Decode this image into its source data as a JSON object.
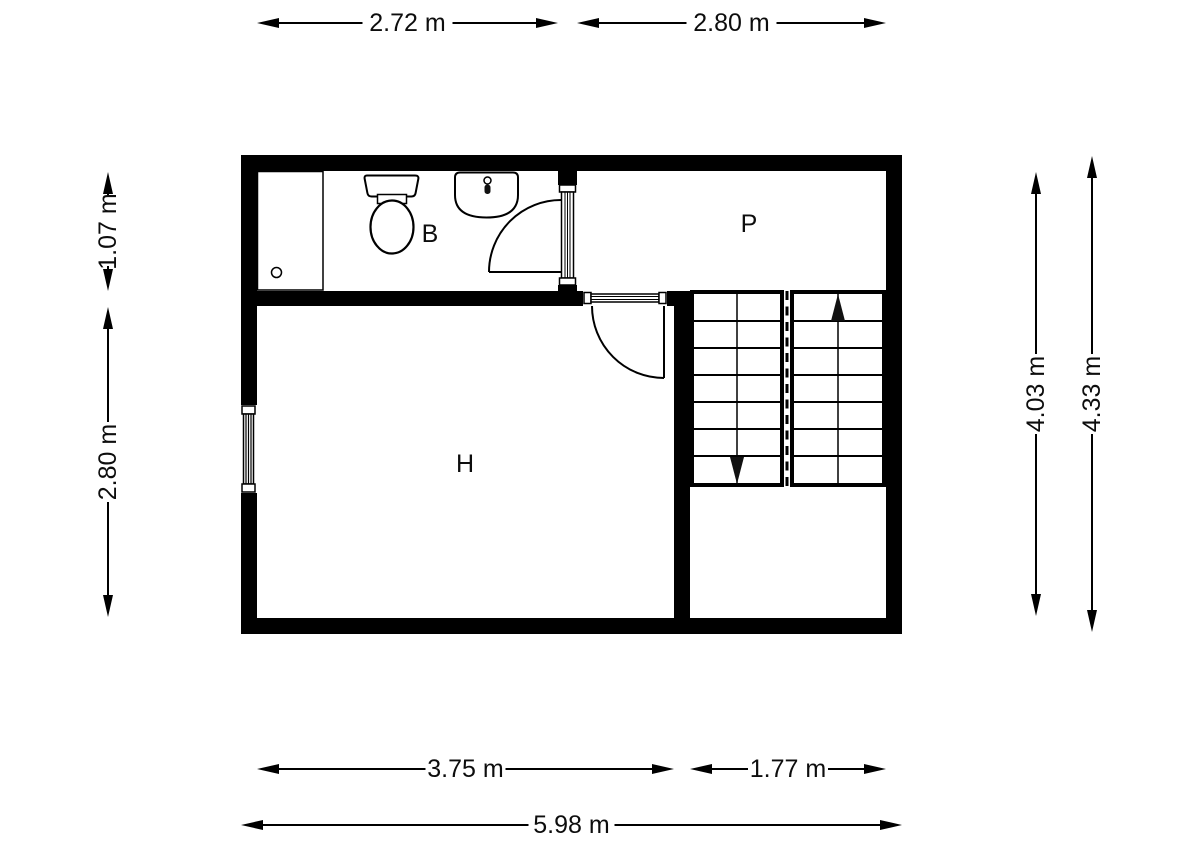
{
  "page": {
    "background": "#ffffff"
  },
  "plan": {
    "unit": "m",
    "wall_color": "#000000",
    "line_color": "#000000",
    "text_color": "#0d0d0d",
    "rooms": {
      "bathroom": {
        "label": "B"
      },
      "landing": {
        "label": "P"
      },
      "hall": {
        "label": "H"
      }
    },
    "dimensions": {
      "top_bathroom": "2.72 m",
      "top_landing": "2.80 m",
      "left_bathroom": "1.07 m",
      "left_hall": "2.80 m",
      "right_inner": "4.03 m",
      "right_total": "4.33 m",
      "bottom_hall": "3.75 m",
      "bottom_stairs": "1.77 m",
      "bottom_total": "5.98 m"
    },
    "stairs": {
      "flights": 2,
      "treads_per_flight": 7,
      "direction_arrows": [
        "down",
        "up"
      ]
    },
    "fixtures": [
      "shower-tray",
      "toilet",
      "sink"
    ],
    "openings": {
      "doors": 2,
      "windows": 1
    }
  }
}
